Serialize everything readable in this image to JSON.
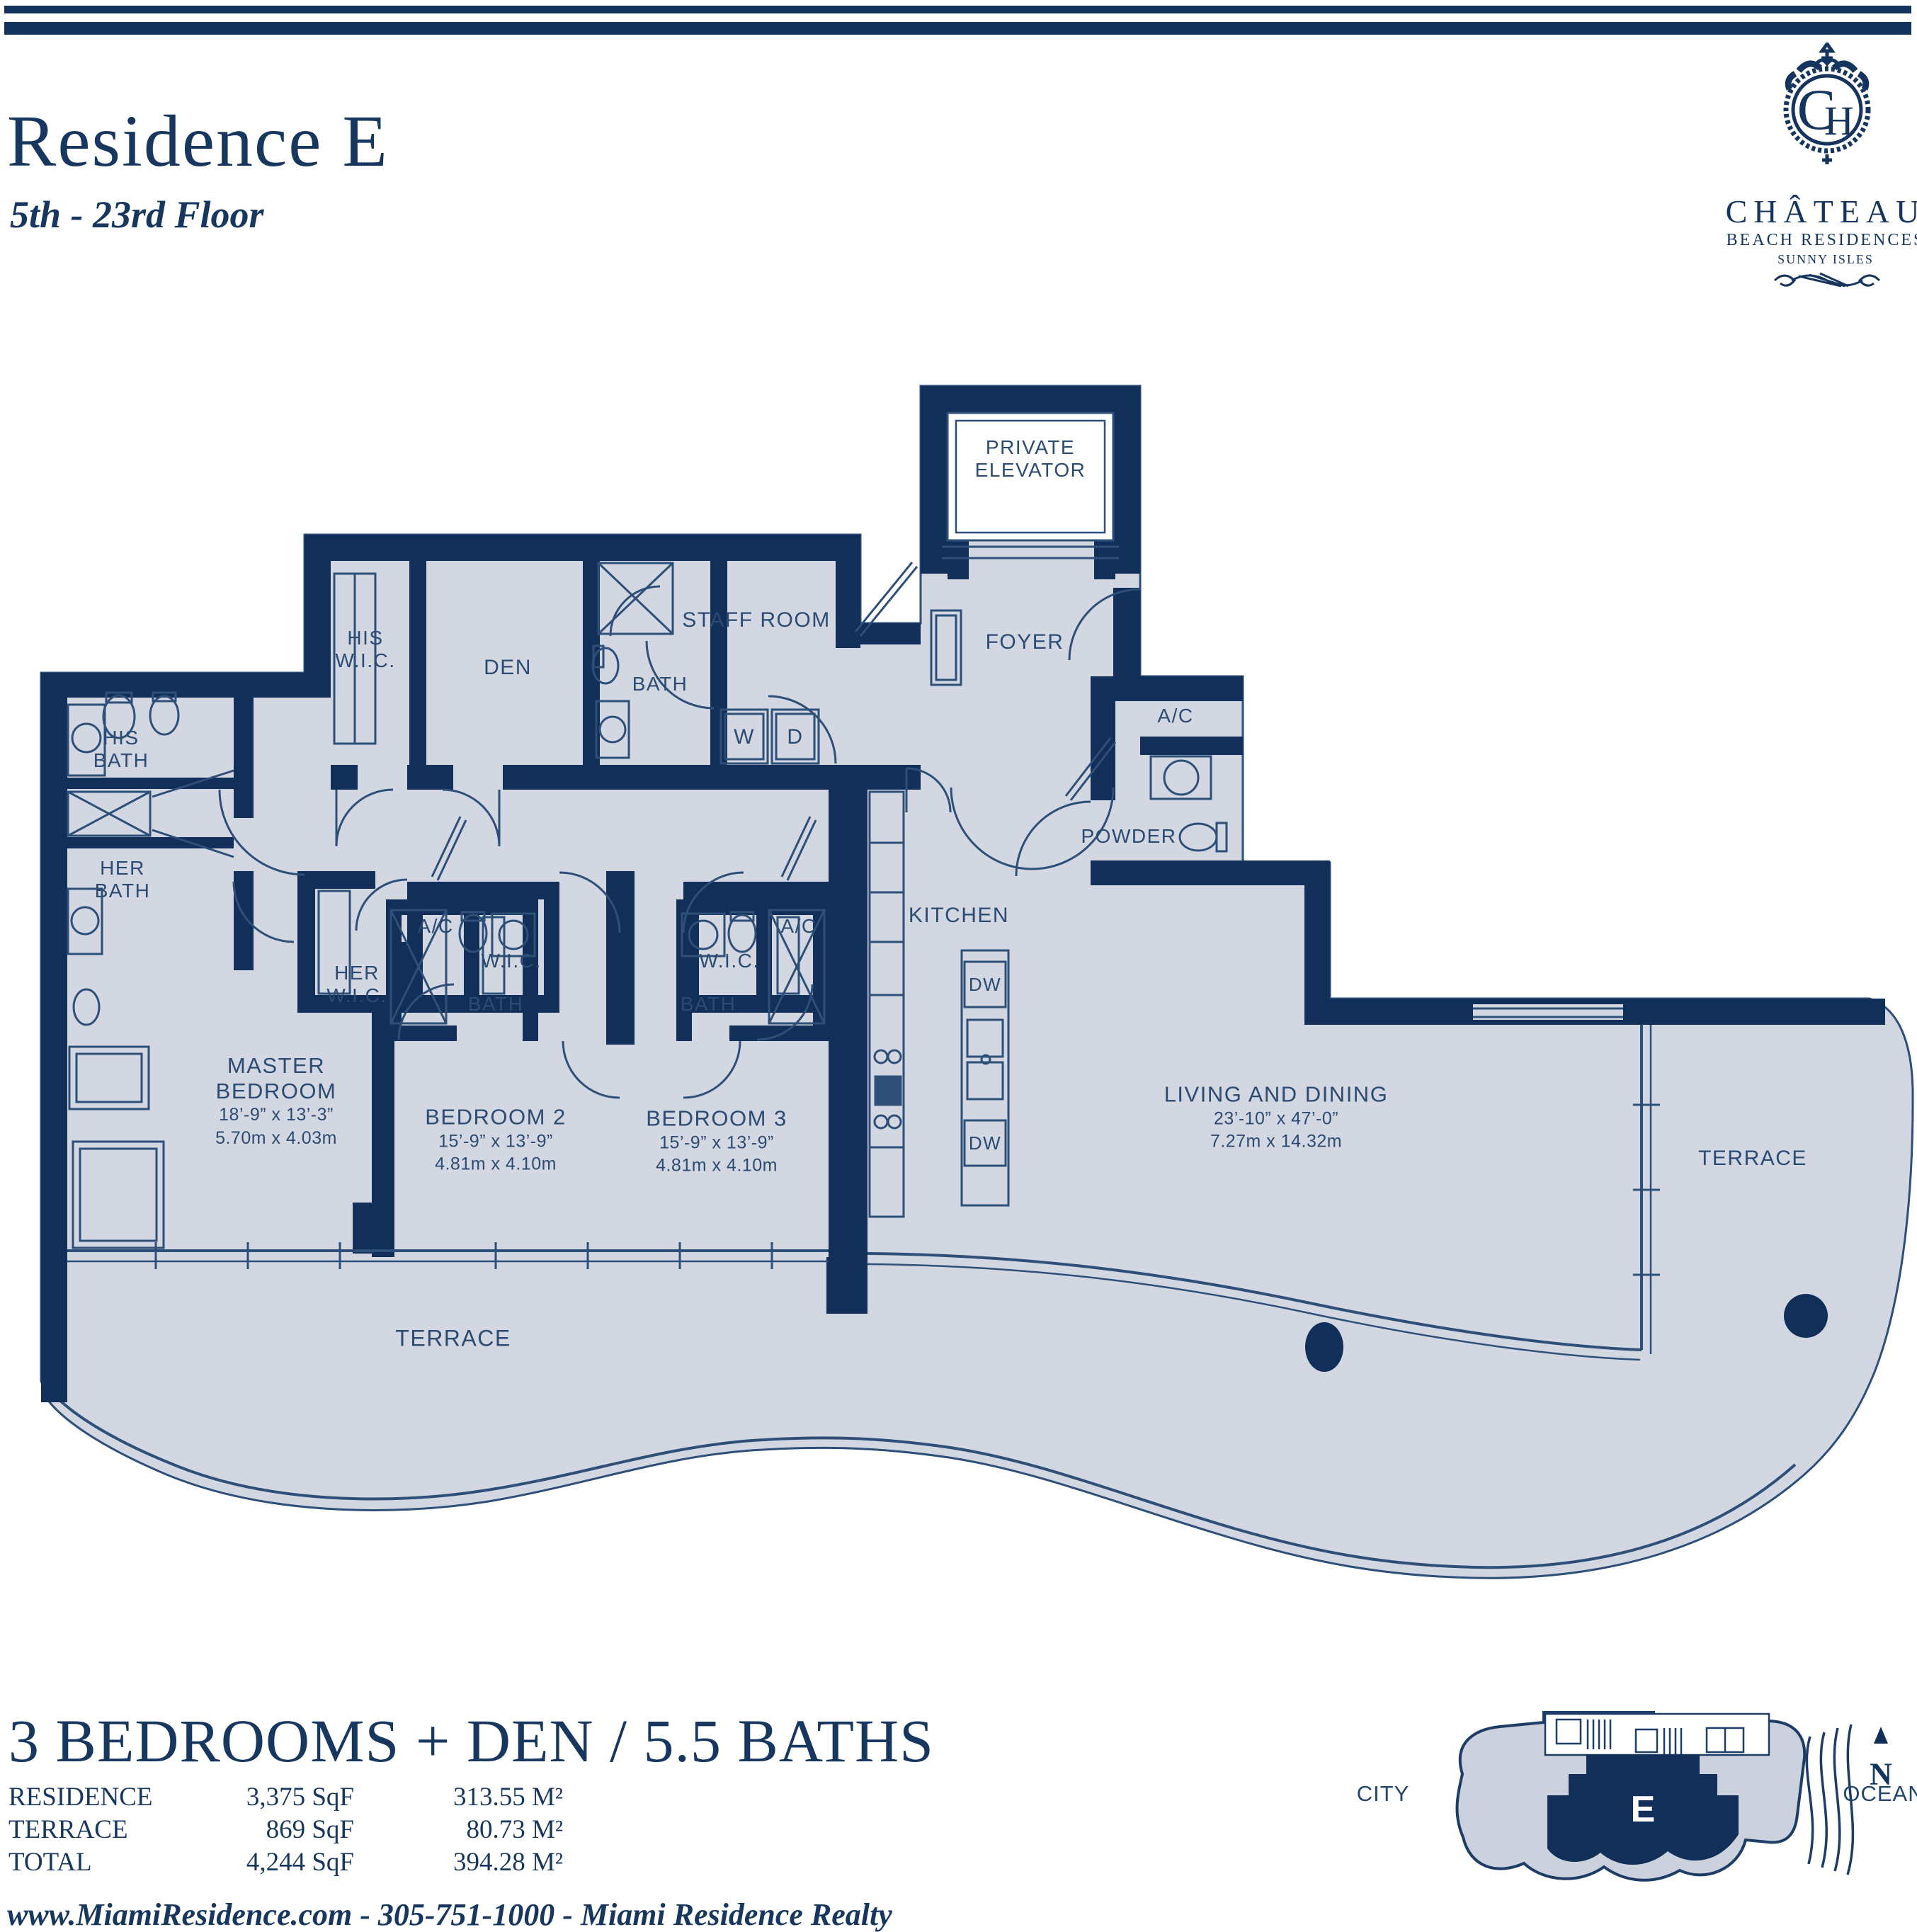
{
  "header": {
    "title": "Residence E",
    "subtitle": "5th - 23rd Floor"
  },
  "logo": {
    "monogram_c": "C",
    "monogram_h": "H",
    "name": "CHÂTEAU",
    "line2": "BEACH RESIDENCES",
    "line3": "SUNNY ISLES"
  },
  "plan": {
    "private_elevator": "PRIVATE\nELEVATOR",
    "his_wic": "HIS\nW.I.C.",
    "den": "DEN",
    "staff_room": "STAFF ROOM",
    "bath": "BATH",
    "washer": "W",
    "dryer": "D",
    "foyer": "FOYER",
    "ac": "A/C",
    "powder": "POWDER",
    "his_bath": "HIS\nBATH",
    "her_bath": "HER\nBATH",
    "her_wic": "HER\nW.I.C.",
    "wic": "W.I.C.",
    "kitchen": "KITCHEN",
    "dw": "DW",
    "terrace": "TERRACE",
    "master": {
      "name": "MASTER\nBEDROOM",
      "dim_ft": "18’-9” x 13’-3”",
      "dim_m": "5.70m x 4.03m"
    },
    "bedroom2": {
      "name": "BEDROOM 2",
      "dim_ft": "15’-9” x 13’-9”",
      "dim_m": "4.81m x 4.10m"
    },
    "bedroom3": {
      "name": "BEDROOM 3",
      "dim_ft": "15’-9” x 13’-9”",
      "dim_m": "4.81m x 4.10m"
    },
    "living": {
      "name": "LIVING AND DINING",
      "dim_ft": "23’-10” x 47’-0”",
      "dim_m": "7.27m x 14.32m"
    }
  },
  "summary": {
    "headline": "3 BEDROOMS + DEN / 5.5 BATHS",
    "rows": [
      {
        "label": "RESIDENCE",
        "sqf": "3,375 SqF",
        "m2": "313.55 M²"
      },
      {
        "label": "TERRACE",
        "sqf": "869 SqF",
        "m2": "80.73 M²"
      },
      {
        "label": "TOTAL",
        "sqf": "4,244 SqF",
        "m2": "394.28 M²"
      }
    ]
  },
  "keymap": {
    "unit": "E",
    "city": "CITY",
    "ocean": "OCEAN",
    "north": "N"
  },
  "footer": "www.MiamiResidence.com  -  305-751-1000  -  Miami Residence Realty"
}
